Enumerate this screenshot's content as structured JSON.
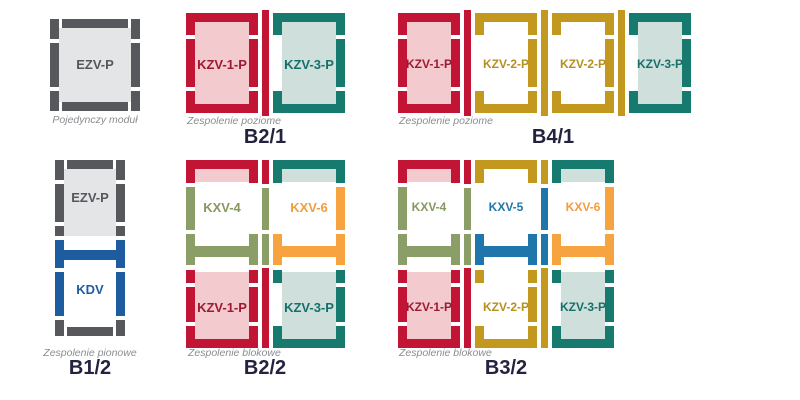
{
  "diagram_title": "Roof window flashing combination modules",
  "palette": {
    "red": "#c21536",
    "pink_fill": "#f3cacd",
    "teal": "#177a6f",
    "teal_fill": "#cfdfdb",
    "gold": "#c3981f",
    "olive": "#8c9e68",
    "orange": "#f7a440",
    "steel_blue": "#1f76aa",
    "navy_blue": "#1d5c9f",
    "dark_gray": "#57585c",
    "gray_fill": "#e4e5e7",
    "caption_gray": "#8a8c90",
    "badge_navy": "#23233f"
  },
  "groups": {
    "single": {
      "caption": "Pojedynczy moduł",
      "modules": [
        {
          "label": "EZV-P"
        }
      ]
    },
    "b21": {
      "caption": "Zespolenie poziome",
      "badge": "B2/1",
      "modules": [
        {
          "label": "KZV-1-P"
        },
        {
          "label": "KZV-3-P"
        }
      ]
    },
    "b41": {
      "caption": "Zespolenie poziome",
      "badge": "B4/1",
      "modules": [
        {
          "label": "KZV-1-P"
        },
        {
          "label": "KZV-2-P"
        },
        {
          "label": "KZV-2-P"
        },
        {
          "label": "KZV-3-P"
        }
      ]
    },
    "b12": {
      "caption": "Zespolenie pionowe",
      "badge": "B1/2",
      "modules": [
        {
          "label": "EZV-P"
        },
        {
          "label": "KDV"
        }
      ]
    },
    "b22": {
      "caption": "Zespolenie blokowe",
      "badge": "B2/2",
      "modules": [
        {
          "label": "KXV-4"
        },
        {
          "label": "KXV-6"
        },
        {
          "label": "KZV-1-P"
        },
        {
          "label": "KZV-3-P"
        }
      ]
    },
    "b32": {
      "caption": "Zespolenie blokowe",
      "badge": "B3/2",
      "modules": [
        {
          "label": "KXV-4"
        },
        {
          "label": "KXV-5"
        },
        {
          "label": "KXV-6"
        },
        {
          "label": "KZV-1-P"
        },
        {
          "label": "KZV-2-P"
        },
        {
          "label": "KZV-3-P"
        }
      ]
    }
  }
}
